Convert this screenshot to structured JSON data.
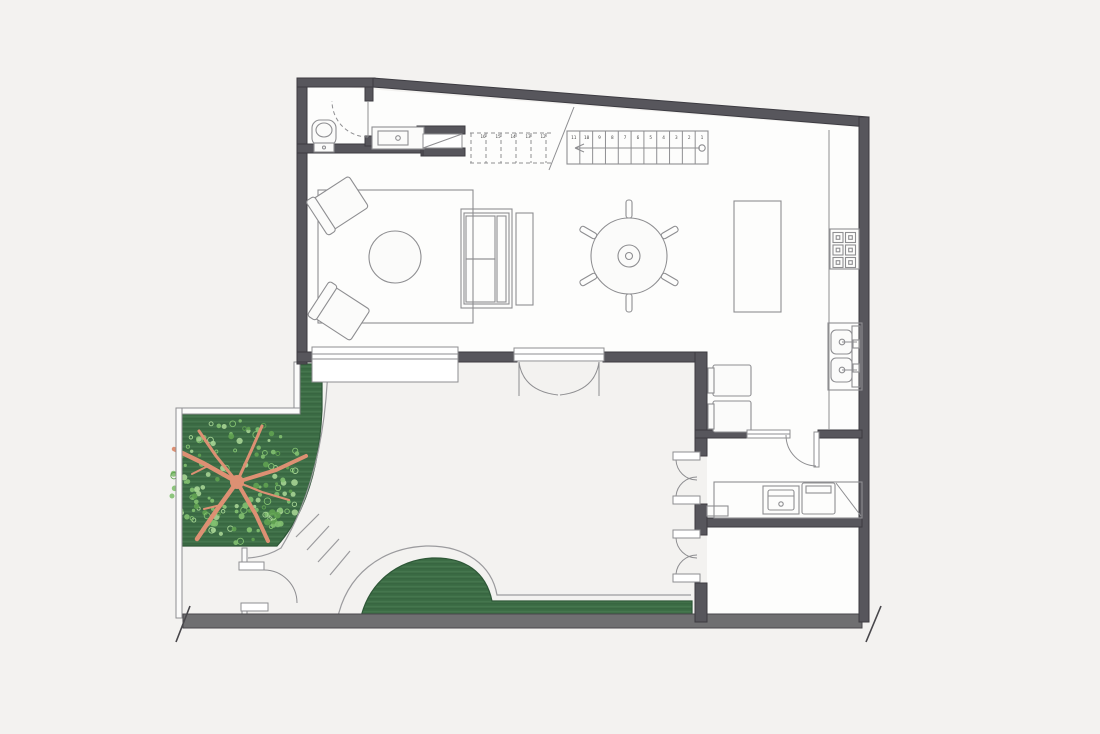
{
  "title": "residential-ground-floor-plan",
  "canvas": {
    "width": 1100,
    "height": 734
  },
  "palette": {
    "background": "#f3f2f0",
    "wall_fill": "#57565c",
    "wall_edge": "#3c3b41",
    "floor": "#fdfdfc",
    "line": "#8e8e91",
    "line_light": "#b5b5b8",
    "fixture_fill": "#fbfbfa",
    "grass": "#3c6d45",
    "grass_edge": "#2e5737",
    "grass_stripe_light": "#4a7b52",
    "grass_stripe_dark": "#35613d",
    "foliage_main": "#82c070",
    "foliage_light": "#a6d494",
    "foliage_dark": "#61a251",
    "branch": "#dd9073",
    "street_wall_fill": "#6f6f71",
    "street_wall_edge": "#48474b",
    "path_line": "#9b9b9e"
  },
  "stairs": {
    "solid_treads": 11,
    "dashed_treads": 6,
    "step_numbers": [
      "1",
      "2",
      "3",
      "4",
      "5",
      "6",
      "7",
      "8",
      "9",
      "10",
      "11",
      "12",
      "13",
      "14",
      "15",
      "16"
    ],
    "direction_arrow": "left",
    "start_marker": "circle"
  },
  "cooktop": {
    "burner_rows": 3,
    "burner_cols": 2
  },
  "kitchen_sink": {
    "basin_count": 2
  },
  "dining": {
    "chair_count": 6
  },
  "tree": {
    "foliage_dot_count": 150,
    "seed": 11,
    "center_x": 237,
    "center_y": 481,
    "radius": 64
  },
  "garden_steps": {
    "count": 4
  },
  "inventory": [
    "toilet",
    "vanity-sink",
    "understair-shelf",
    "staircase",
    "living-rug",
    "coffee-table",
    "armchair",
    "armchair",
    "sofa",
    "console-table",
    "dining-table",
    "kitchen-island",
    "cooktop",
    "kitchen-sink",
    "breakfast-chairs",
    "laundry-counter",
    "laundry-sink",
    "washing-machine",
    "window-seat",
    "french-doors",
    "patio-doors",
    "entry-gate",
    "tree",
    "lawn"
  ]
}
